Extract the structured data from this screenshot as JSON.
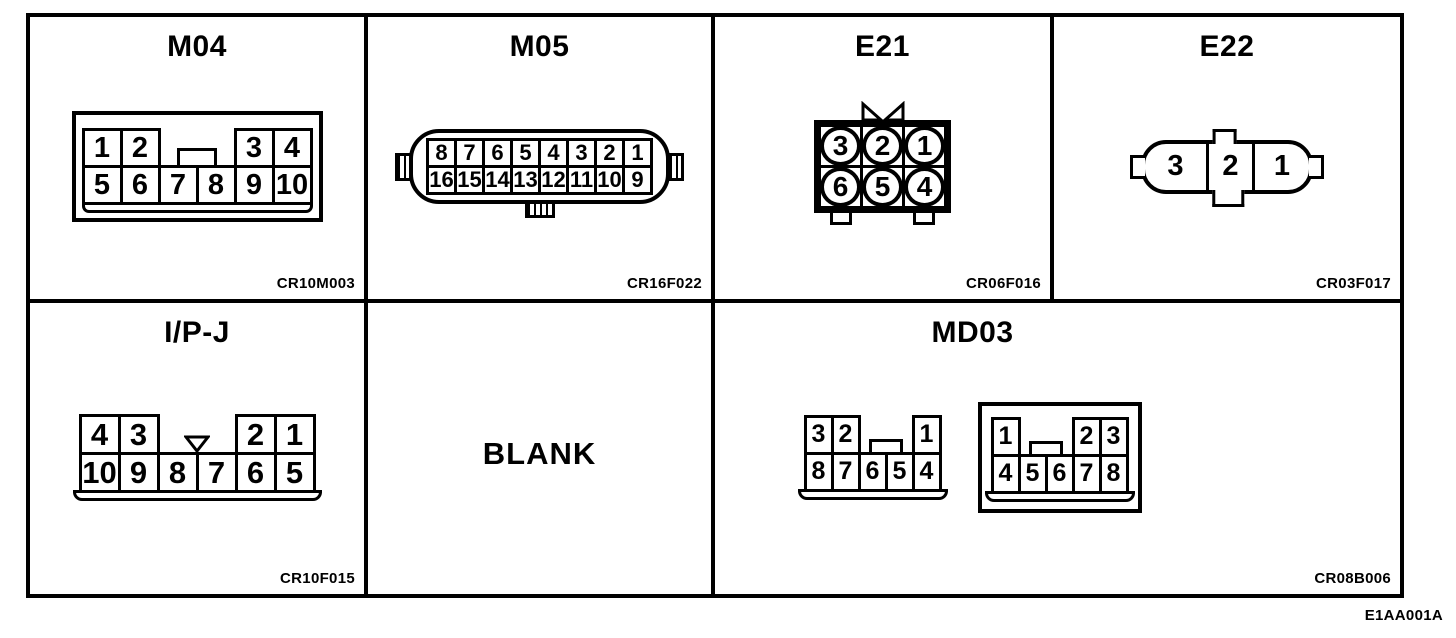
{
  "footer_code": "E1AA001A",
  "colors": {
    "ink": "#000000",
    "paper": "#ffffff"
  },
  "cells": {
    "m04": {
      "title": "M04",
      "code": "CR10M003",
      "pins_top": [
        "1",
        "2",
        "3",
        "4"
      ],
      "pins_bottom": [
        "5",
        "6",
        "7",
        "8",
        "9",
        "10"
      ]
    },
    "m05": {
      "title": "M05",
      "code": "CR16F022",
      "pins_top": [
        "8",
        "7",
        "6",
        "5",
        "4",
        "3",
        "2",
        "1"
      ],
      "pins_bottom": [
        "16",
        "15",
        "14",
        "13",
        "12",
        "11",
        "10",
        "9"
      ]
    },
    "e21": {
      "title": "E21",
      "code": "CR06F016",
      "pins_top": [
        "3",
        "2",
        "1"
      ],
      "pins_bottom": [
        "6",
        "5",
        "4"
      ]
    },
    "e22": {
      "title": "E22",
      "code": "CR03F017",
      "pins": [
        "3",
        "2",
        "1"
      ]
    },
    "ipj": {
      "title": "I/P-J",
      "code": "CR10F015",
      "pins_top": [
        "4",
        "3",
        "2",
        "1"
      ],
      "pins_bottom": [
        "10",
        "9",
        "8",
        "7",
        "6",
        "5"
      ]
    },
    "blank": {
      "label": "BLANK"
    },
    "md03": {
      "title": "MD03",
      "code": "CR08B006",
      "left_connector": {
        "pins_top": [
          "3",
          "2",
          "1"
        ],
        "pins_bottom": [
          "8",
          "7",
          "6",
          "5",
          "4"
        ]
      },
      "right_connector": {
        "pins_top": [
          "1",
          "2",
          "3"
        ],
        "pins_bottom": [
          "4",
          "5",
          "6",
          "7",
          "8"
        ]
      }
    }
  }
}
